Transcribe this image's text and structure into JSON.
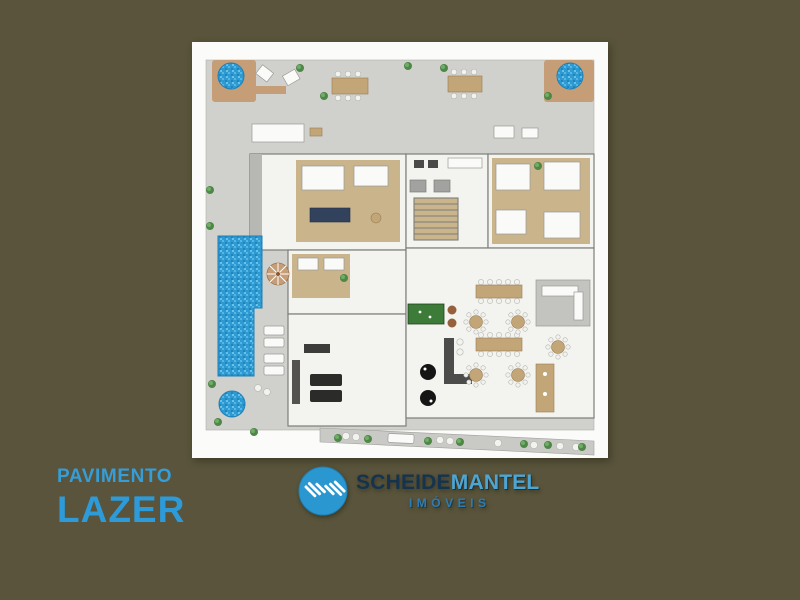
{
  "caption": {
    "line1": "PAVIMENTO",
    "line2": "LAZER"
  },
  "logo": {
    "name_part1": "SCHEIDE",
    "name_part2": "MANTEL",
    "subtitle": "IMÓVEIS"
  },
  "colors": {
    "background": "#59543B",
    "card": "#FBFBFA",
    "caption_blue": "#359DD8",
    "logo_navy": "#16334E",
    "logo_light_blue": "#4DA5D4",
    "logo_circle_blue": "#2B97D1",
    "pool_water_blue": "#2F9AD2",
    "terrace_gray": "#D0D0CC",
    "wood_tan": "#C9B48C",
    "deck_tan": "#C59E77",
    "lawn_green": "#3C7C38"
  },
  "floorplan": {
    "plants": [
      [
        108,
        26
      ],
      [
        216,
        24
      ],
      [
        252,
        26
      ],
      [
        356,
        54
      ],
      [
        132,
        54
      ],
      [
        18,
        148
      ],
      [
        18,
        184
      ],
      [
        152,
        236
      ],
      [
        346,
        124
      ],
      [
        20,
        342
      ],
      [
        26,
        380
      ],
      [
        62,
        390
      ],
      [
        146,
        396
      ],
      [
        176,
        397
      ],
      [
        236,
        399
      ],
      [
        268,
        400
      ],
      [
        332,
        402
      ],
      [
        356,
        403
      ],
      [
        390,
        405
      ]
    ],
    "round_tables": [
      [
        284,
        280
      ],
      [
        326,
        280
      ],
      [
        284,
        333
      ],
      [
        326,
        333
      ],
      [
        366,
        305
      ]
    ]
  }
}
